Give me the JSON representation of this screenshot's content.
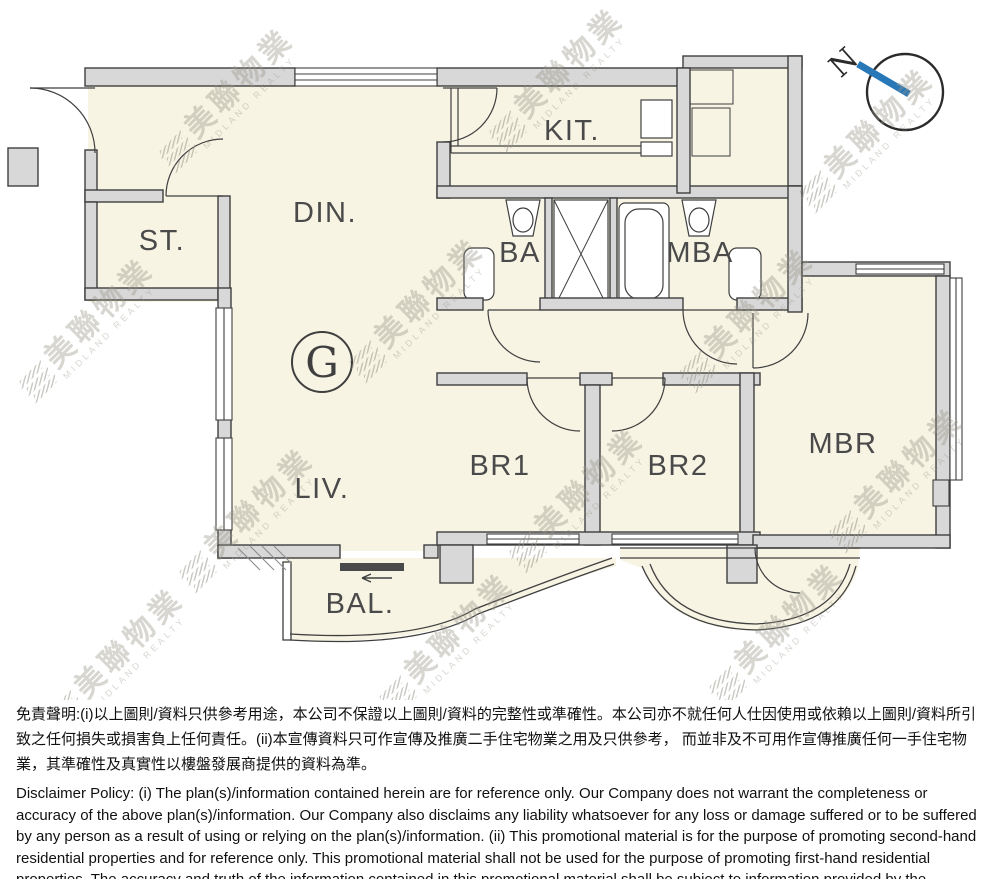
{
  "floorplan": {
    "unit_label": "G",
    "rooms": {
      "kit": "KIT.",
      "din": "DIN.",
      "st": "ST.",
      "ba": "BA",
      "mba": "MBA",
      "br1": "BR1",
      "br2": "BR2",
      "mbr": "MBR",
      "liv": "LIV.",
      "bal": "BAL."
    },
    "compass": {
      "label": "N",
      "needle_color": "#2878b8"
    }
  },
  "watermark": {
    "cn": "美聯物業",
    "en": "MIDLAND REALTY"
  },
  "disclaimer": {
    "zh": "免責聲明:(i)以上圖則/資料只供參考用途，本公司不保證以上圖則/資料的完整性或準確性。本公司亦不就任何人仕因使用或依賴以上圖則/資料所引致之任何損失或損害負上任何責任。(ii)本宣傳資料只可作宣傳及推廣二手住宅物業之用及只供參考， 而並非及不可用作宣傳推廣任何一手住宅物業，其準確性及真實性以樓盤發展商提供的資料為準。",
    "en": "Disclaimer Policy: (i) The plan(s)/information contained herein are for reference only. Our Company does not warrant the completeness or accuracy of the above plan(s)/information. Our Company also disclaims any liability whatsoever for any loss or damage suffered or to be suffered by any person as a result of using or relying on the plan(s)/information. (ii) This promotional material is for the purpose of promoting second-hand residential properties and for reference only. This promotional material shall not be used for the purpose of promoting first-hand residential properties. The accuracy and truth of the information contained in this promotional material shall be subject to information provided by the developers."
  },
  "colors": {
    "wall": "#d8d8d8",
    "floor": "#f7f4e4",
    "line": "#3f3f3f"
  }
}
